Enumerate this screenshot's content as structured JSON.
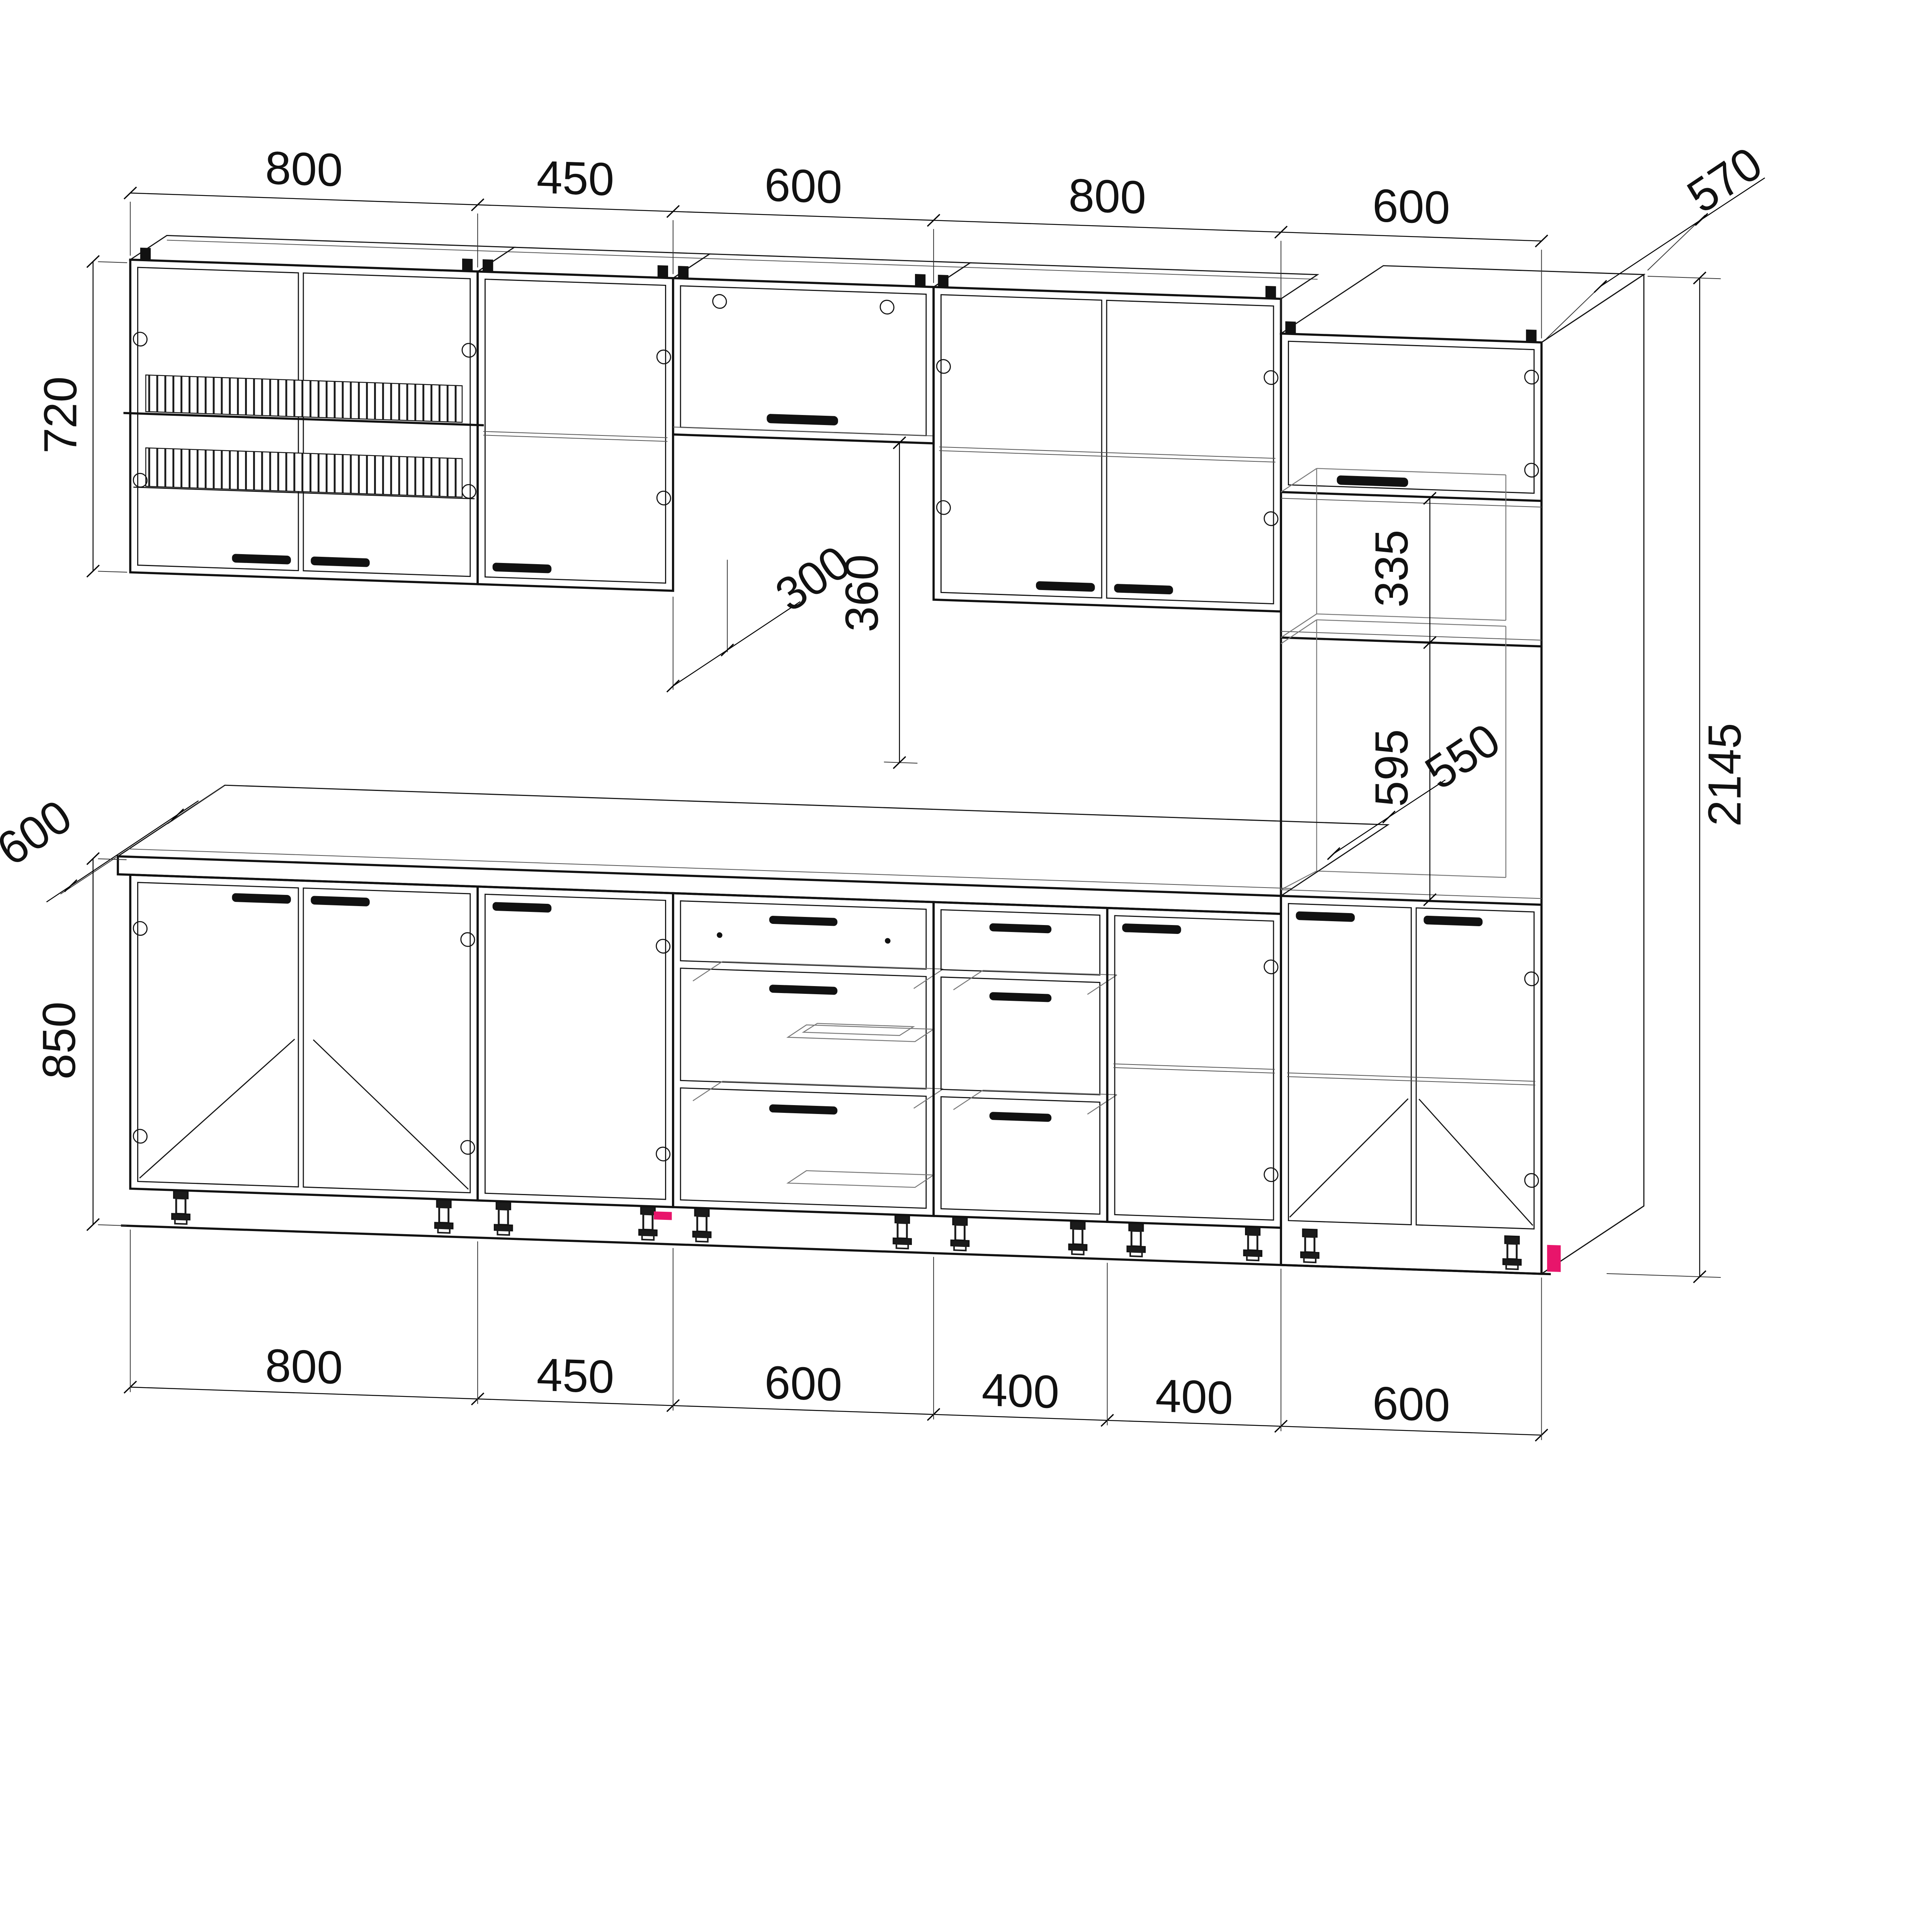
{
  "drawing": {
    "type": "kitchen-cabinet-assembly-wireframe",
    "background_color": "#ffffff",
    "line_color": "#111111",
    "accent_color": "#e8156b"
  },
  "dims": {
    "top": [
      "800",
      "450",
      "600",
      "800",
      "600"
    ],
    "top_depth": "570",
    "wall_height": "720",
    "wall_depth": "300",
    "under_lift": "360",
    "niche_height": "335",
    "oven_depth": "550",
    "oven_height": "595",
    "column_height": "2145",
    "counter_depth": "600",
    "base_height": "850",
    "bottom": [
      "800",
      "450",
      "600",
      "400",
      "400",
      "600"
    ]
  },
  "modules": {
    "wall_row": [
      {
        "width_mm": "800",
        "kind": "two-door wall cabinet with plate drying rack"
      },
      {
        "width_mm": "450",
        "kind": "single-door wall cabinet with shelf"
      },
      {
        "width_mm": "600",
        "kind": "lift-up wall cabinet, height 360"
      },
      {
        "width_mm": "800",
        "kind": "two-door wall cabinet with shelf"
      },
      {
        "width_mm": "600",
        "kind": "tall oven column, total height 2145, depth 570"
      }
    ],
    "base_row": [
      {
        "width_mm": "800",
        "kind": "two-door base cabinet"
      },
      {
        "width_mm": "450",
        "kind": "single-door base cabinet"
      },
      {
        "width_mm": "600",
        "kind": "three-drawer base cabinet with cutlery tray"
      },
      {
        "width_mm": "400",
        "kind": "three-drawer base cabinet"
      },
      {
        "width_mm": "400",
        "kind": "single-door base cabinet"
      },
      {
        "width_mm": "600",
        "kind": "tall column base section, two doors"
      }
    ]
  }
}
